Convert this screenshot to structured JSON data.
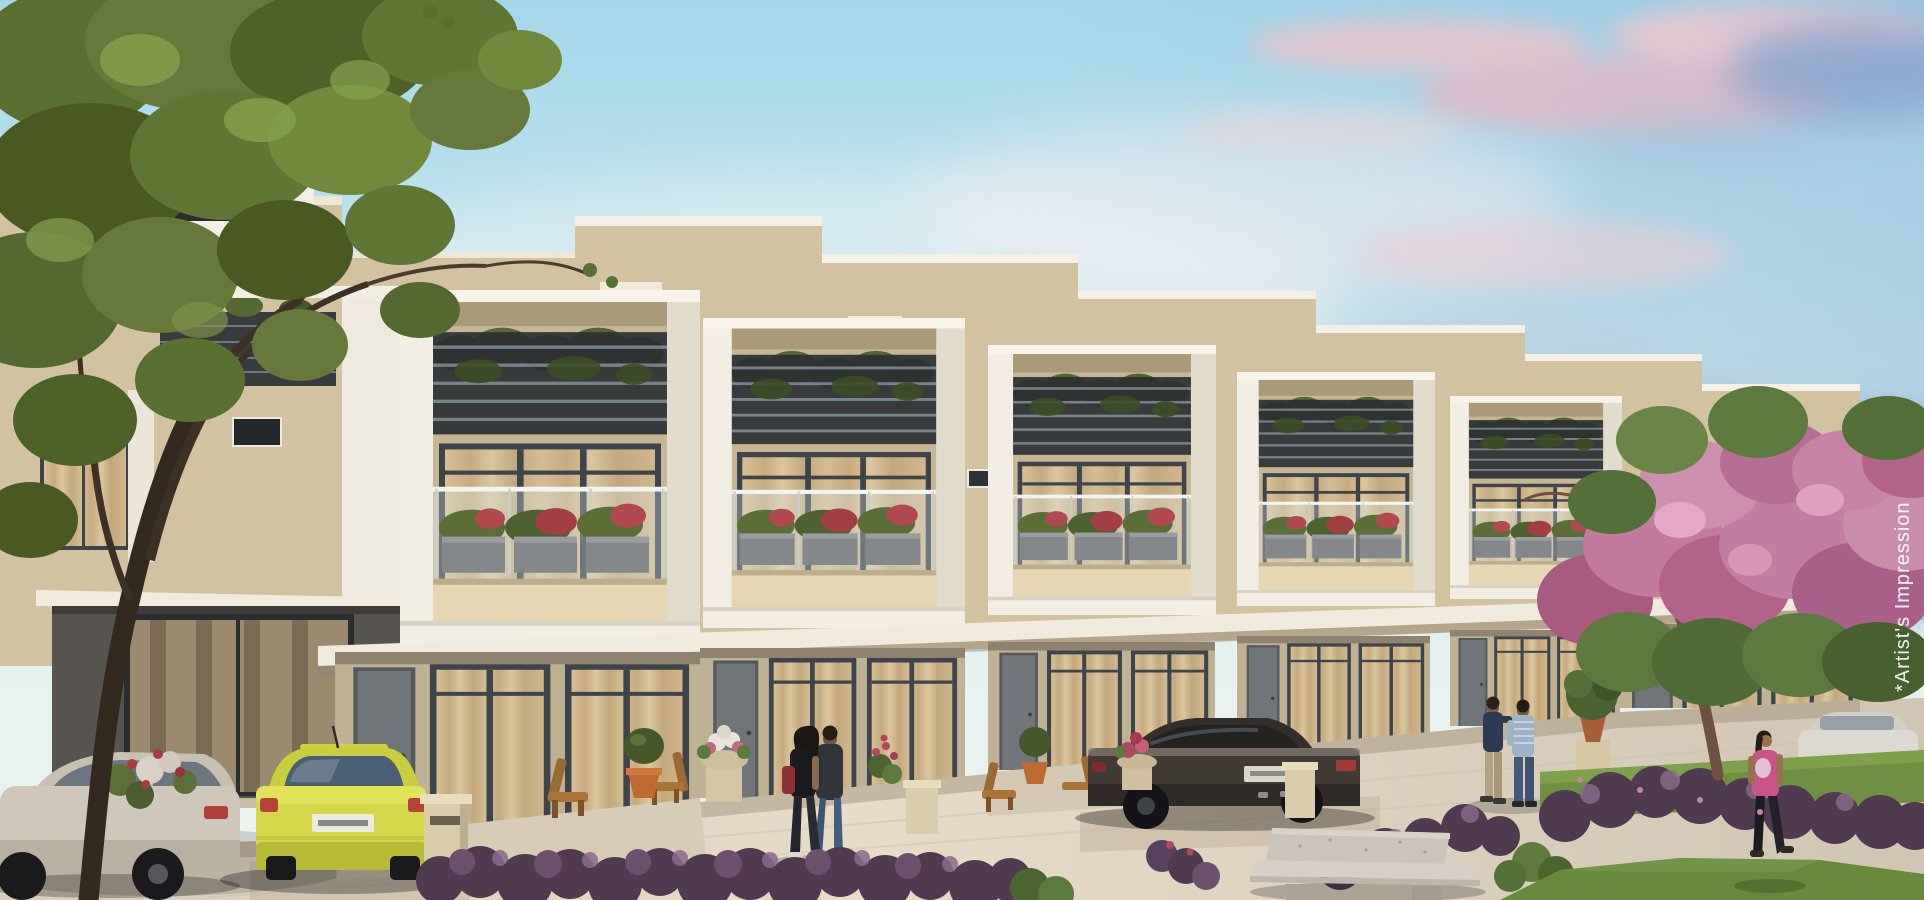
{
  "meta": {
    "type": "architectural-rendering",
    "subject": "Row of modern duplex villas at dusk with landscaped walkway, terrace planters, parked cars and pedestrians"
  },
  "overlay": {
    "watermark": "*Artist's Impression"
  },
  "counts": {
    "villas": 6,
    "cars": 4,
    "pedestrians": 5
  },
  "palette": {
    "sky_top": "#a3d7ea",
    "sky_haze": "#e7f2f0",
    "cloud_pink": "#e5b6c4",
    "cloud_blue": "#7e99c3",
    "villa_wall": "#d3c29f",
    "villa_wall_shade": "#c7b694",
    "frame_white": "#f2eee4",
    "terrace_railing": "#2c3033",
    "curtain": "#d0b88c",
    "window_frame": "#3f444a",
    "canopy_white": "#f0ebdd",
    "ground_wall": "#bfb193",
    "door_gray": "#70757a",
    "pavement": "#e4dac6",
    "hedge_purple": "#5a4060",
    "hedge_highlight": "#8a6a8c",
    "lawn": "#6f8f42",
    "bench_stone": "#c9c3b9",
    "car_yellow": "#d4d748",
    "car_dark": "#413b35",
    "car_silver": "#cfc8ba",
    "car_white": "#dcd9d2",
    "tree_green": "#66793a",
    "tree_trunk": "#33291f",
    "blossom_pink": "#c27b9e",
    "flower_red": "#b0485e"
  },
  "objects": [
    "sky",
    "clouds",
    "villa-row",
    "terrace-planters",
    "glass-balconies",
    "walkway",
    "silver-car",
    "yellow-hatchback",
    "dark-sedan",
    "distant-white-car",
    "couple-walking",
    "two-men-talking",
    "woman-in-pink",
    "purple-hedges",
    "lawn",
    "stone-bench",
    "green-tree",
    "pink-blossom-tree",
    "garden-urns",
    "patio-chairs"
  ]
}
